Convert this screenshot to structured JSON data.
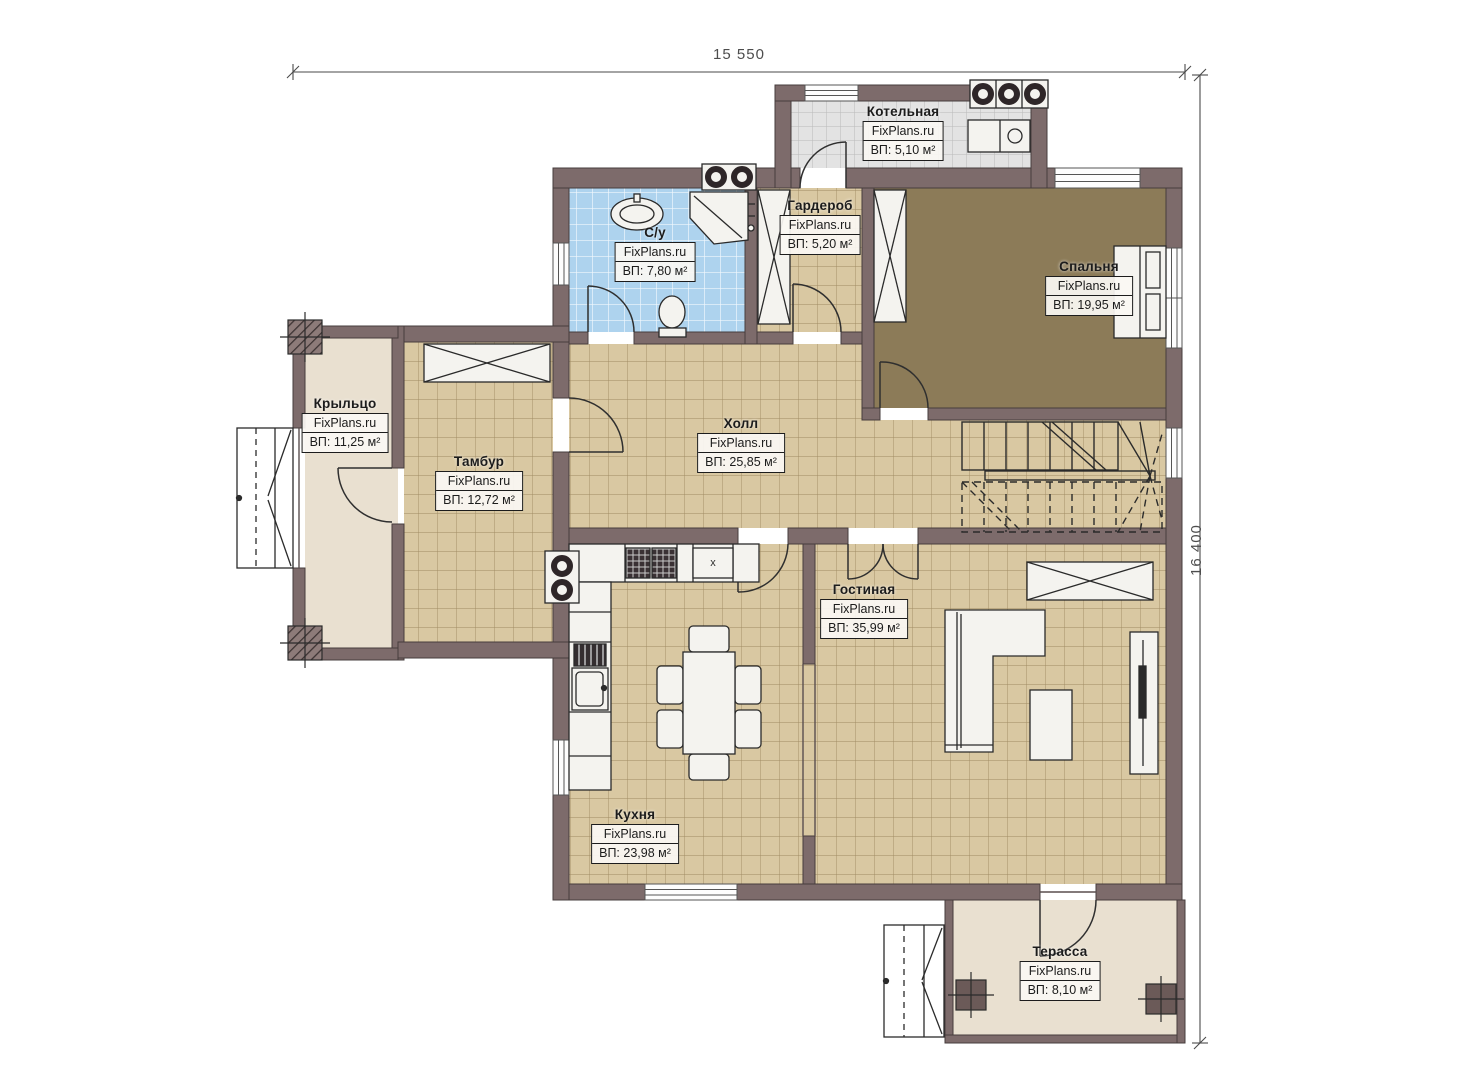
{
  "plan_title": "floor-plan",
  "dimensions": {
    "top": "15 550",
    "right": "16 400"
  },
  "marks": {
    "kitchen_unit": "x"
  },
  "colors": {
    "wall": "#7d6b6b",
    "wall_outline": "#463c3c",
    "floor_tan": "#d9c8a2",
    "floor_tan_grid": "#9f8a62",
    "floor_bedroom": "#8c7b58",
    "floor_blue_tile": "#aed3ee",
    "floor_gray_tile": "#e3e3e3",
    "floor_beige": "#e9e0d0",
    "furniture_fill": "#f4f3ef",
    "line_dark": "#2a2a2a"
  },
  "rooms": [
    {
      "id": "boiler",
      "name": "Котельная",
      "watermark": "FixPlans.ru",
      "area": "ВП: 5,10 м²"
    },
    {
      "id": "bathroom",
      "name": "С/у",
      "watermark": "FixPlans.ru",
      "area": "ВП: 7,80 м²"
    },
    {
      "id": "wardrobe",
      "name": "Гардероб",
      "watermark": "FixPlans.ru",
      "area": "ВП: 5,20 м²"
    },
    {
      "id": "bedroom",
      "name": "Спальня",
      "watermark": "FixPlans.ru",
      "area": "ВП: 19,95 м²"
    },
    {
      "id": "porch",
      "name": "Крыльцо",
      "watermark": "FixPlans.ru",
      "area": "ВП: 11,25 м²"
    },
    {
      "id": "vestibule",
      "name": "Тамбур",
      "watermark": "FixPlans.ru",
      "area": "ВП: 12,72 м²"
    },
    {
      "id": "hall",
      "name": "Холл",
      "watermark": "FixPlans.ru",
      "area": "ВП: 25,85 м²"
    },
    {
      "id": "living",
      "name": "Гостиная",
      "watermark": "FixPlans.ru",
      "area": "ВП: 35,99 м²"
    },
    {
      "id": "kitchen",
      "name": "Кухня",
      "watermark": "FixPlans.ru",
      "area": "ВП: 23,98 м²"
    },
    {
      "id": "terrace",
      "name": "Терасса",
      "watermark": "FixPlans.ru",
      "area": "ВП: 8,10 м²"
    }
  ]
}
